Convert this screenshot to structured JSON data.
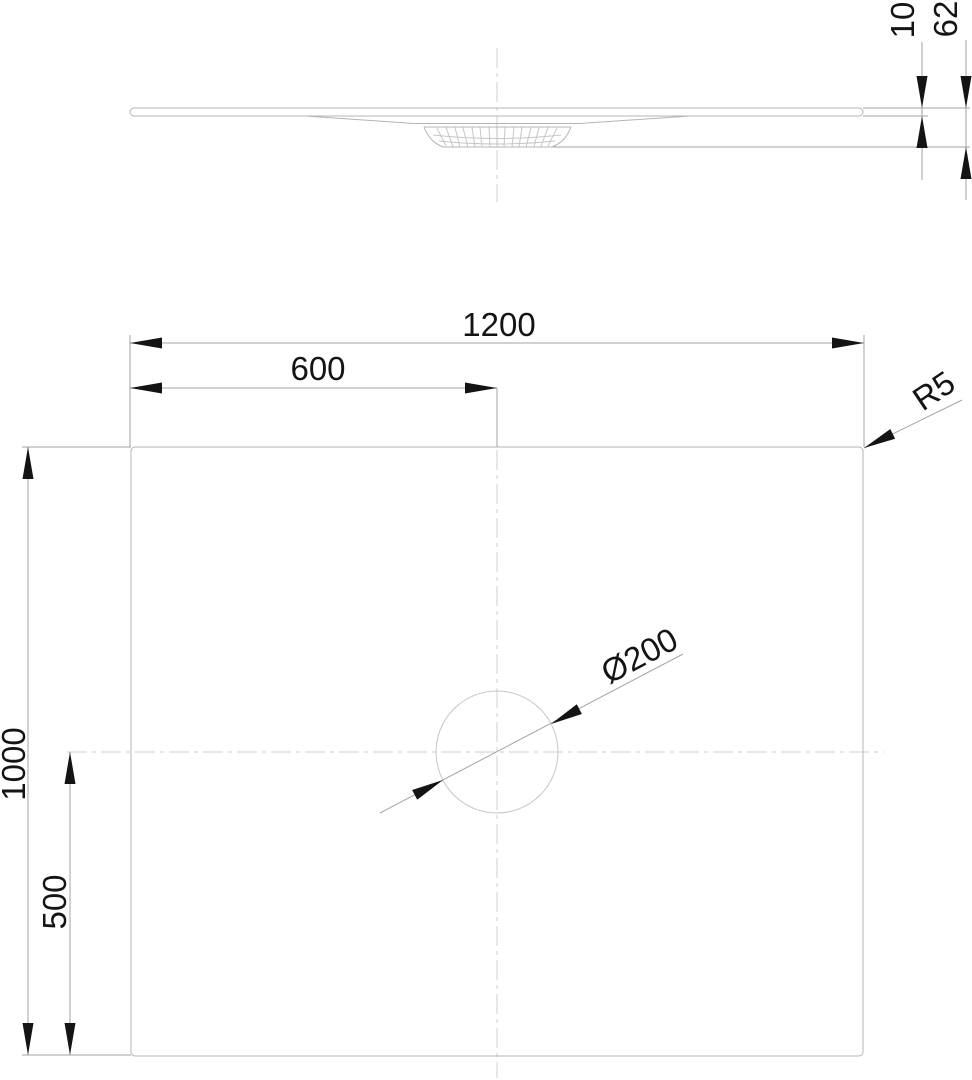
{
  "colors": {
    "geometry_line": "#b4b4b4",
    "dimension_line": "#a3a3a3",
    "centerline": "#d8d8d8",
    "text_and_arrows": "#141414",
    "background": "#ffffff"
  },
  "views": {
    "side": {
      "labels": {
        "rim_height": "10",
        "total_height": "62"
      }
    },
    "plan": {
      "labels": {
        "width": "1200",
        "center_x": "600",
        "depth": "1000",
        "center_y": "500",
        "corner_radius": "R5",
        "drain_diameter": "Ø200"
      }
    }
  }
}
